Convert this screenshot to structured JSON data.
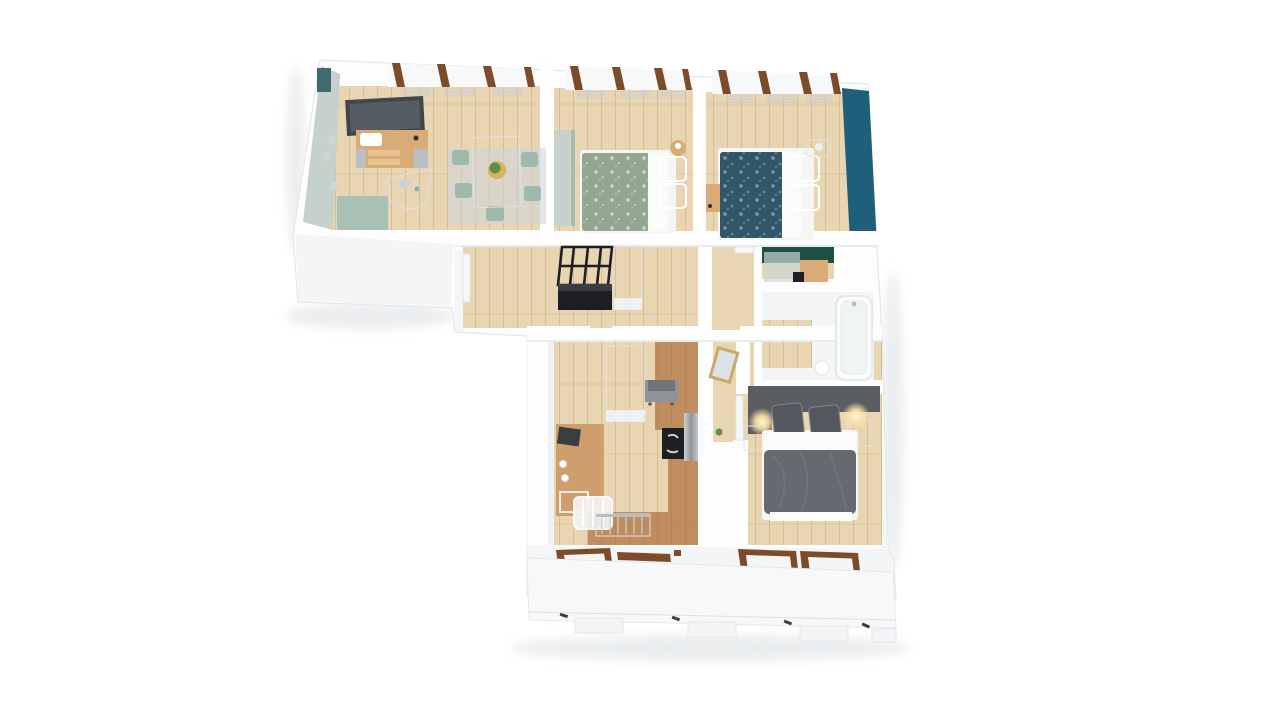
{
  "meta": {
    "title": "3D apartment floor plan render",
    "view": "top-down 3D perspective",
    "background": "#ffffff"
  },
  "palette": {
    "wall_top": "#fdfdfe",
    "wall_face": "#f3f5f7",
    "wall_face_dark": "#e9ecef",
    "floor_wood": "#e8d5b1",
    "floor_wood_hall": "#e4cfa8",
    "floor_terracotta": "#c08d5e",
    "floor_bath": "#f4f5f6",
    "accent_sage_wall": "#c6d1cb",
    "accent_teal_wall": "#1f5f7a",
    "accent_green_wall": "#1d4f43",
    "teal_corner": "#3e6a70",
    "sage_furniture": "#9fb9ad",
    "bench_teal": "#a9c0b5",
    "wood_furniture": "#d9ac77",
    "desk_wood": "#cf9e6d",
    "bed_green": "#93a68f",
    "bed_green_pillow": "#9db0a0",
    "bed_navy": "#34566a",
    "bed_navy_pillow": "#3c5f74",
    "bed_gray_duvet": "#66696f",
    "bed_gray_pillow": "#54585e",
    "headboard_gray": "#5a5e63",
    "black_furniture": "#1d1f22",
    "appliance_gray": "#8e9499",
    "appliance_gray_dark": "#6e7478",
    "tv_dark": "#41464c",
    "window_brown": "#7b4b2a",
    "rug_blue": "#ccd6da",
    "mirror_gold": "#c8a96e",
    "mirror_glass": "#dde3e5",
    "radiator": "#e7eaec",
    "plant_green": "#5f8f46",
    "plant_pot": "#d8b25e",
    "white": "#ffffff"
  },
  "rooms": [
    {
      "id": "dining-room",
      "label": "dining / kids room",
      "features": [
        "wall-tv",
        "wooden-sideboard",
        "bassinet",
        "dining-table",
        "plant-centerpiece",
        "four-sage-chairs",
        "blue-rug",
        "teal-bench",
        "wall-sconces",
        "tall-windows",
        "radiators"
      ]
    },
    {
      "id": "bedroom-green",
      "label": "bedroom with green floral bed",
      "features": [
        "sage-wardrobe",
        "double-bed-green-duvet",
        "two-pillows",
        "round-wood-stool",
        "tall-windows"
      ]
    },
    {
      "id": "bedroom-teal",
      "label": "bedroom with teal accent wall",
      "features": [
        "teal-accent-wall",
        "double-bed-navy-duvet",
        "white-nightstand",
        "table-lamp",
        "wood-side-table",
        "tall-windows"
      ]
    },
    {
      "id": "hallway",
      "label": "hallway",
      "features": [
        "black-coat-rack",
        "black-cabinet",
        "white-closet",
        "interior-doors"
      ]
    },
    {
      "id": "wc",
      "label": "wc",
      "features": [
        "dark-green-accent-wall",
        "wood-vanity",
        "mirror"
      ]
    },
    {
      "id": "bathroom",
      "label": "bathroom",
      "features": [
        "bathtub",
        "wood-floor-patch"
      ]
    },
    {
      "id": "kitchen-living",
      "label": "kitchen / home office",
      "features": [
        "wood-desk",
        "office-chair",
        "white-closet",
        "gray-stove",
        "black-cooktop",
        "stainless-unit",
        "radiator",
        "terracotta-floor-zone"
      ]
    },
    {
      "id": "bedroom-gray",
      "label": "master bedroom",
      "features": [
        "gray-headboard-wardrobe",
        "double-bed-gray-duvet",
        "two-gray-pillows",
        "two-nightstands",
        "glowing-wall-lamps",
        "gold-framed-mirror",
        "plant"
      ]
    },
    {
      "id": "balcony",
      "label": "balcony ledge",
      "features": [
        "railing-tabs",
        "windows-with-brown-frames"
      ]
    }
  ]
}
